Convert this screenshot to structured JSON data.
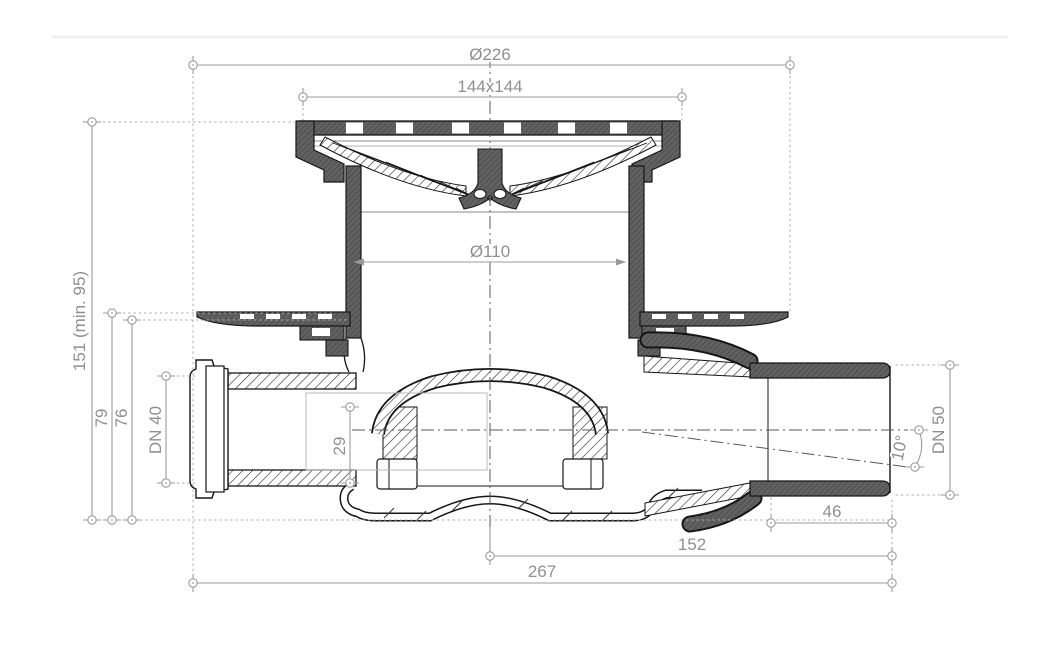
{
  "drawing": {
    "title": "floor-drain-cross-section",
    "dims": {
      "dia_outer": "Ø226",
      "grate": "144x144",
      "dia_body": "Ø110",
      "height_total": "151 (min. 95)",
      "height_flange_top": "79",
      "height_flange_seal": "76",
      "inlet": "DN 40",
      "seal_depth": "29",
      "outlet": "DN 50",
      "outlet_angle": "10°",
      "socket_length": "46",
      "center_to_outlet_end": "152",
      "total_length": "267"
    },
    "colors": {
      "object_line": "#161616",
      "dark_section_fill": "#5f5f5f",
      "dimension_line": "#9b9b9b",
      "dimension_text": "#8f8f8f",
      "background": "#ffffff"
    }
  }
}
